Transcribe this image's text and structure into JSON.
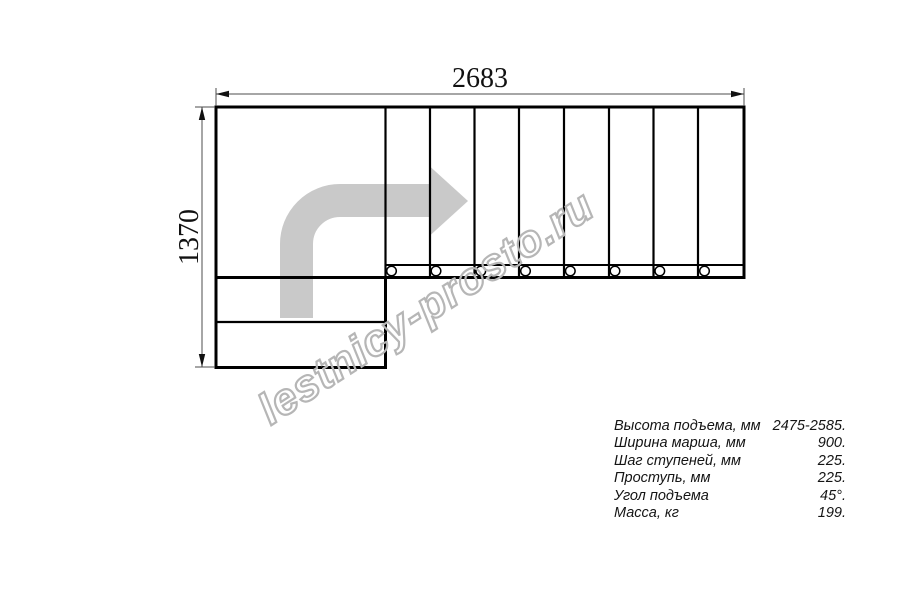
{
  "watermark": {
    "text": "lestnicy-prosto.ru"
  },
  "drawing": {
    "type": "stair-plan-top-view",
    "dimension_width_mm": "2683",
    "dimension_height_mm": "1370",
    "upper_flight_steps_shown": 8,
    "lower_flight_steps_shown": 2,
    "turn": "90°",
    "colors": {
      "outline": "#000000",
      "dimension_lines": "#4d4d4d",
      "walk_arrow": "#c9c9c9",
      "watermark_stroke": "#b6b6b6",
      "background": "#ffffff"
    }
  },
  "specs": {
    "rows": [
      {
        "label": "Высота подъема, мм",
        "value": "2475-2585."
      },
      {
        "label": "Ширина марша, мм",
        "value": "900."
      },
      {
        "label": "Шаг ступеней, мм",
        "value": "225."
      },
      {
        "label": "Проступь, мм",
        "value": "225."
      },
      {
        "label": "Угол подъема",
        "value": "45°."
      },
      {
        "label": "Масса, кг",
        "value": "199."
      }
    ]
  }
}
